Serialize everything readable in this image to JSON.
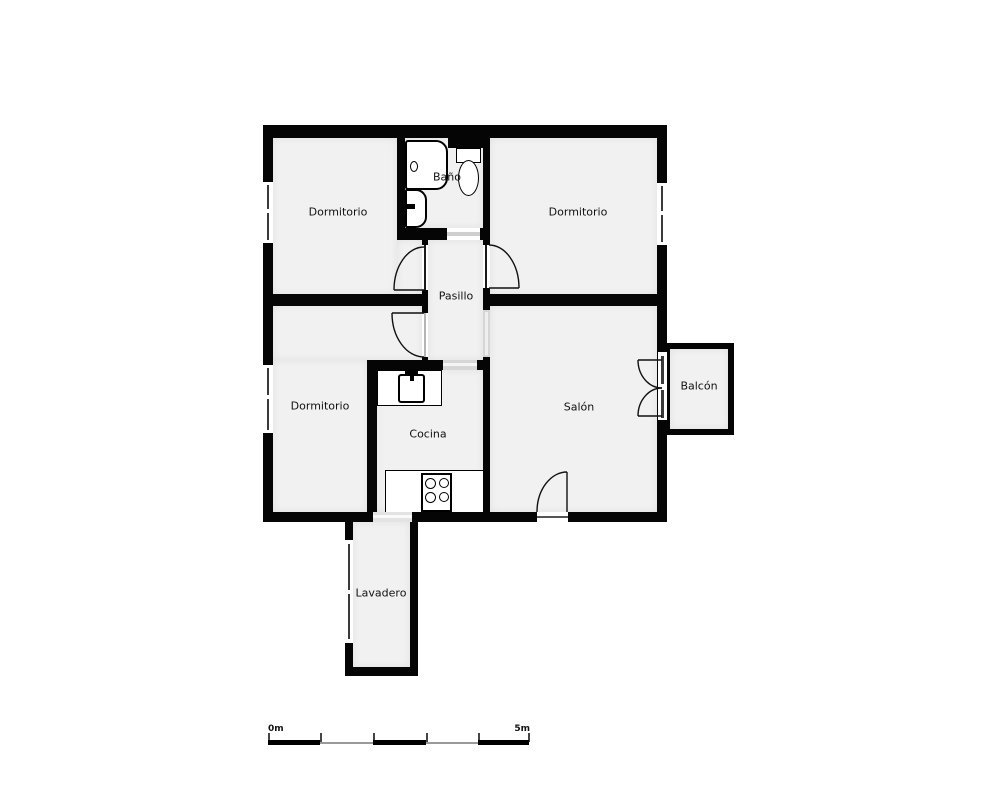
{
  "plan": {
    "title": "apartment-floor-plan",
    "rooms": [
      {
        "id": "dormitorio-top-left",
        "label": "Dormitorio"
      },
      {
        "id": "bano",
        "label": "Baño"
      },
      {
        "id": "dormitorio-top-right",
        "label": "Dormitorio"
      },
      {
        "id": "pasillo",
        "label": "Pasillo"
      },
      {
        "id": "dormitorio-bottom-left",
        "label": "Dormitorio"
      },
      {
        "id": "cocina",
        "label": "Cocina"
      },
      {
        "id": "salon",
        "label": "Salón"
      },
      {
        "id": "balcon",
        "label": "Balcón"
      },
      {
        "id": "lavadero",
        "label": "Lavadero"
      }
    ],
    "fixtures": [
      "bathtub",
      "washbasin",
      "toilet",
      "kitchen-sink",
      "stove-4-burners"
    ],
    "openings": {
      "windows": 4,
      "hinged_doors": 6,
      "open_doorways": 4
    },
    "colors": {
      "wall": "#050505",
      "floor": "#f1f1f1",
      "background": "#ffffff",
      "glass": "#3a3a3a",
      "threshold": "#d6d6d6"
    }
  },
  "scale_bar": {
    "start_label": "0m",
    "end_label": "5m"
  }
}
